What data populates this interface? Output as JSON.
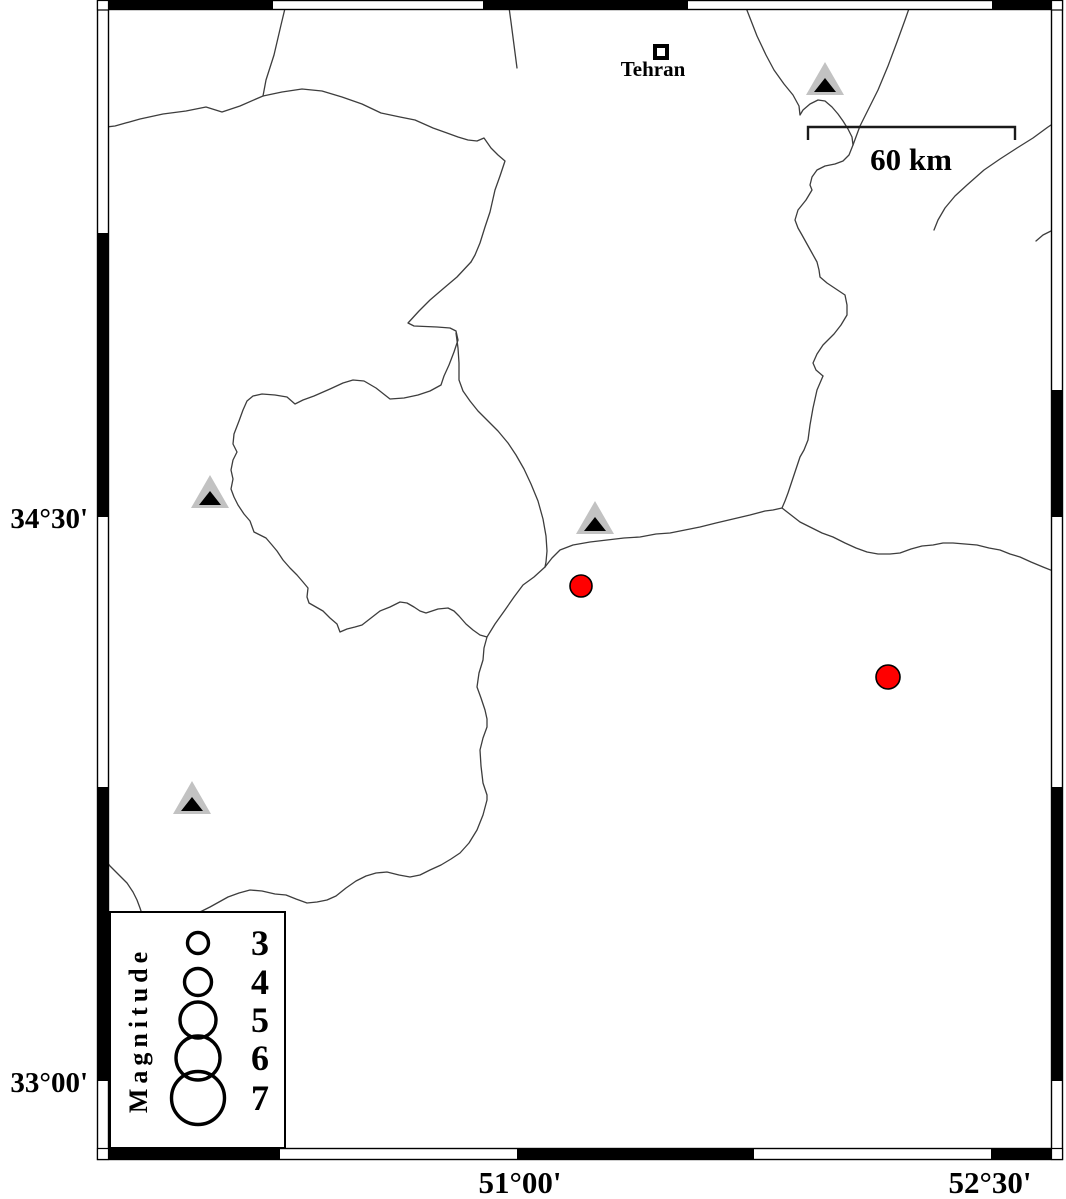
{
  "map": {
    "city": {
      "label": "Tehran"
    },
    "scale_bar": {
      "label": "60 km"
    },
    "axis_labels": {
      "left": [
        {
          "label": "34°30'"
        },
        {
          "label": "33°00'"
        }
      ],
      "bottom": [
        {
          "label": "51°00'"
        },
        {
          "label": "52°30'"
        }
      ]
    },
    "colors": {
      "earthquake_fill": "#ff0000",
      "station_fill": "#c2c2c2",
      "station_core": "#000000",
      "boundary": "#3d3d3d"
    },
    "stations": [
      {
        "cx": 825,
        "cy": 81
      },
      {
        "cx": 210,
        "cy": 494
      },
      {
        "cx": 595,
        "cy": 520
      },
      {
        "cx": 192,
        "cy": 800
      }
    ],
    "earthquakes": [
      {
        "cx": 581,
        "cy": 586,
        "r": 11
      },
      {
        "cx": 888,
        "cy": 677,
        "r": 12
      }
    ]
  },
  "legend": {
    "title": "Magnitude",
    "entries": [
      {
        "magnitude": "3",
        "r": 10.5
      },
      {
        "magnitude": "4",
        "r": 13.5
      },
      {
        "magnitude": "5",
        "r": 18
      },
      {
        "magnitude": "6",
        "r": 22
      },
      {
        "magnitude": "7",
        "r": 26.5
      }
    ]
  }
}
